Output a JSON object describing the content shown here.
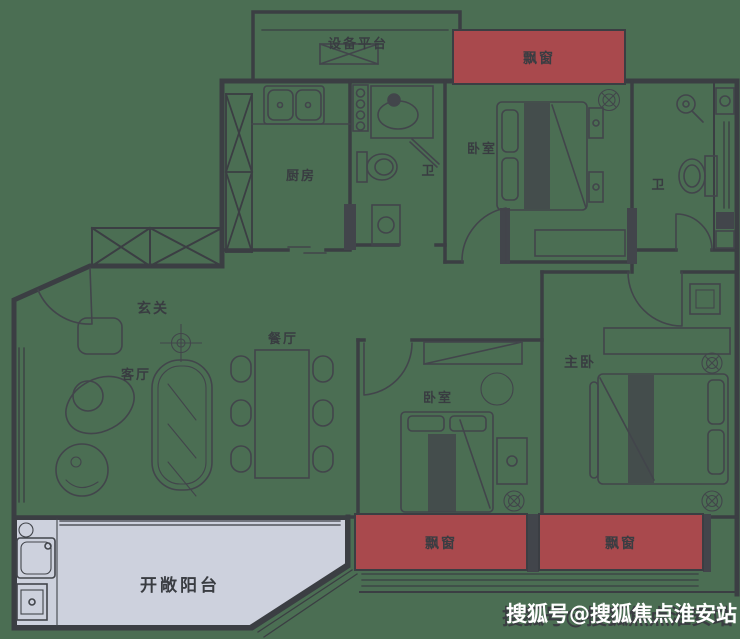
{
  "colors": {
    "background": "#4b6e53",
    "wall": "#3b3e43",
    "bay_window_fill": "#a9494d",
    "balcony_fill": "#cdd1dd",
    "watermark_text": "#ffffff"
  },
  "rooms": {
    "equipment_platform": {
      "label": "设备平台"
    },
    "kitchen": {
      "label": "厨房"
    },
    "bathroom_1": {
      "label": "卫"
    },
    "bedroom_top": {
      "label": "卧室"
    },
    "bathroom_2": {
      "label": "卫"
    },
    "foyer": {
      "label": "玄关"
    },
    "dining_room": {
      "label": "餐厅"
    },
    "living_room": {
      "label": "客厅"
    },
    "bedroom_middle": {
      "label": "卧室"
    },
    "master_bedroom": {
      "label": "主卧"
    },
    "balcony": {
      "label": "开敞阳台"
    }
  },
  "bay_windows": {
    "top": {
      "label": "飘窗"
    },
    "bottom_left": {
      "label": "飘窗"
    },
    "bottom_right": {
      "label": "飘窗"
    }
  },
  "icons": {
    "fan_coil": "circle-with-x",
    "ceiling_light": "circle-with-cross",
    "shower": "shower-head",
    "exhaust_fan": "bowtie-rect"
  },
  "watermark": {
    "text": "搜狐号@搜狐焦点淮安站"
  }
}
